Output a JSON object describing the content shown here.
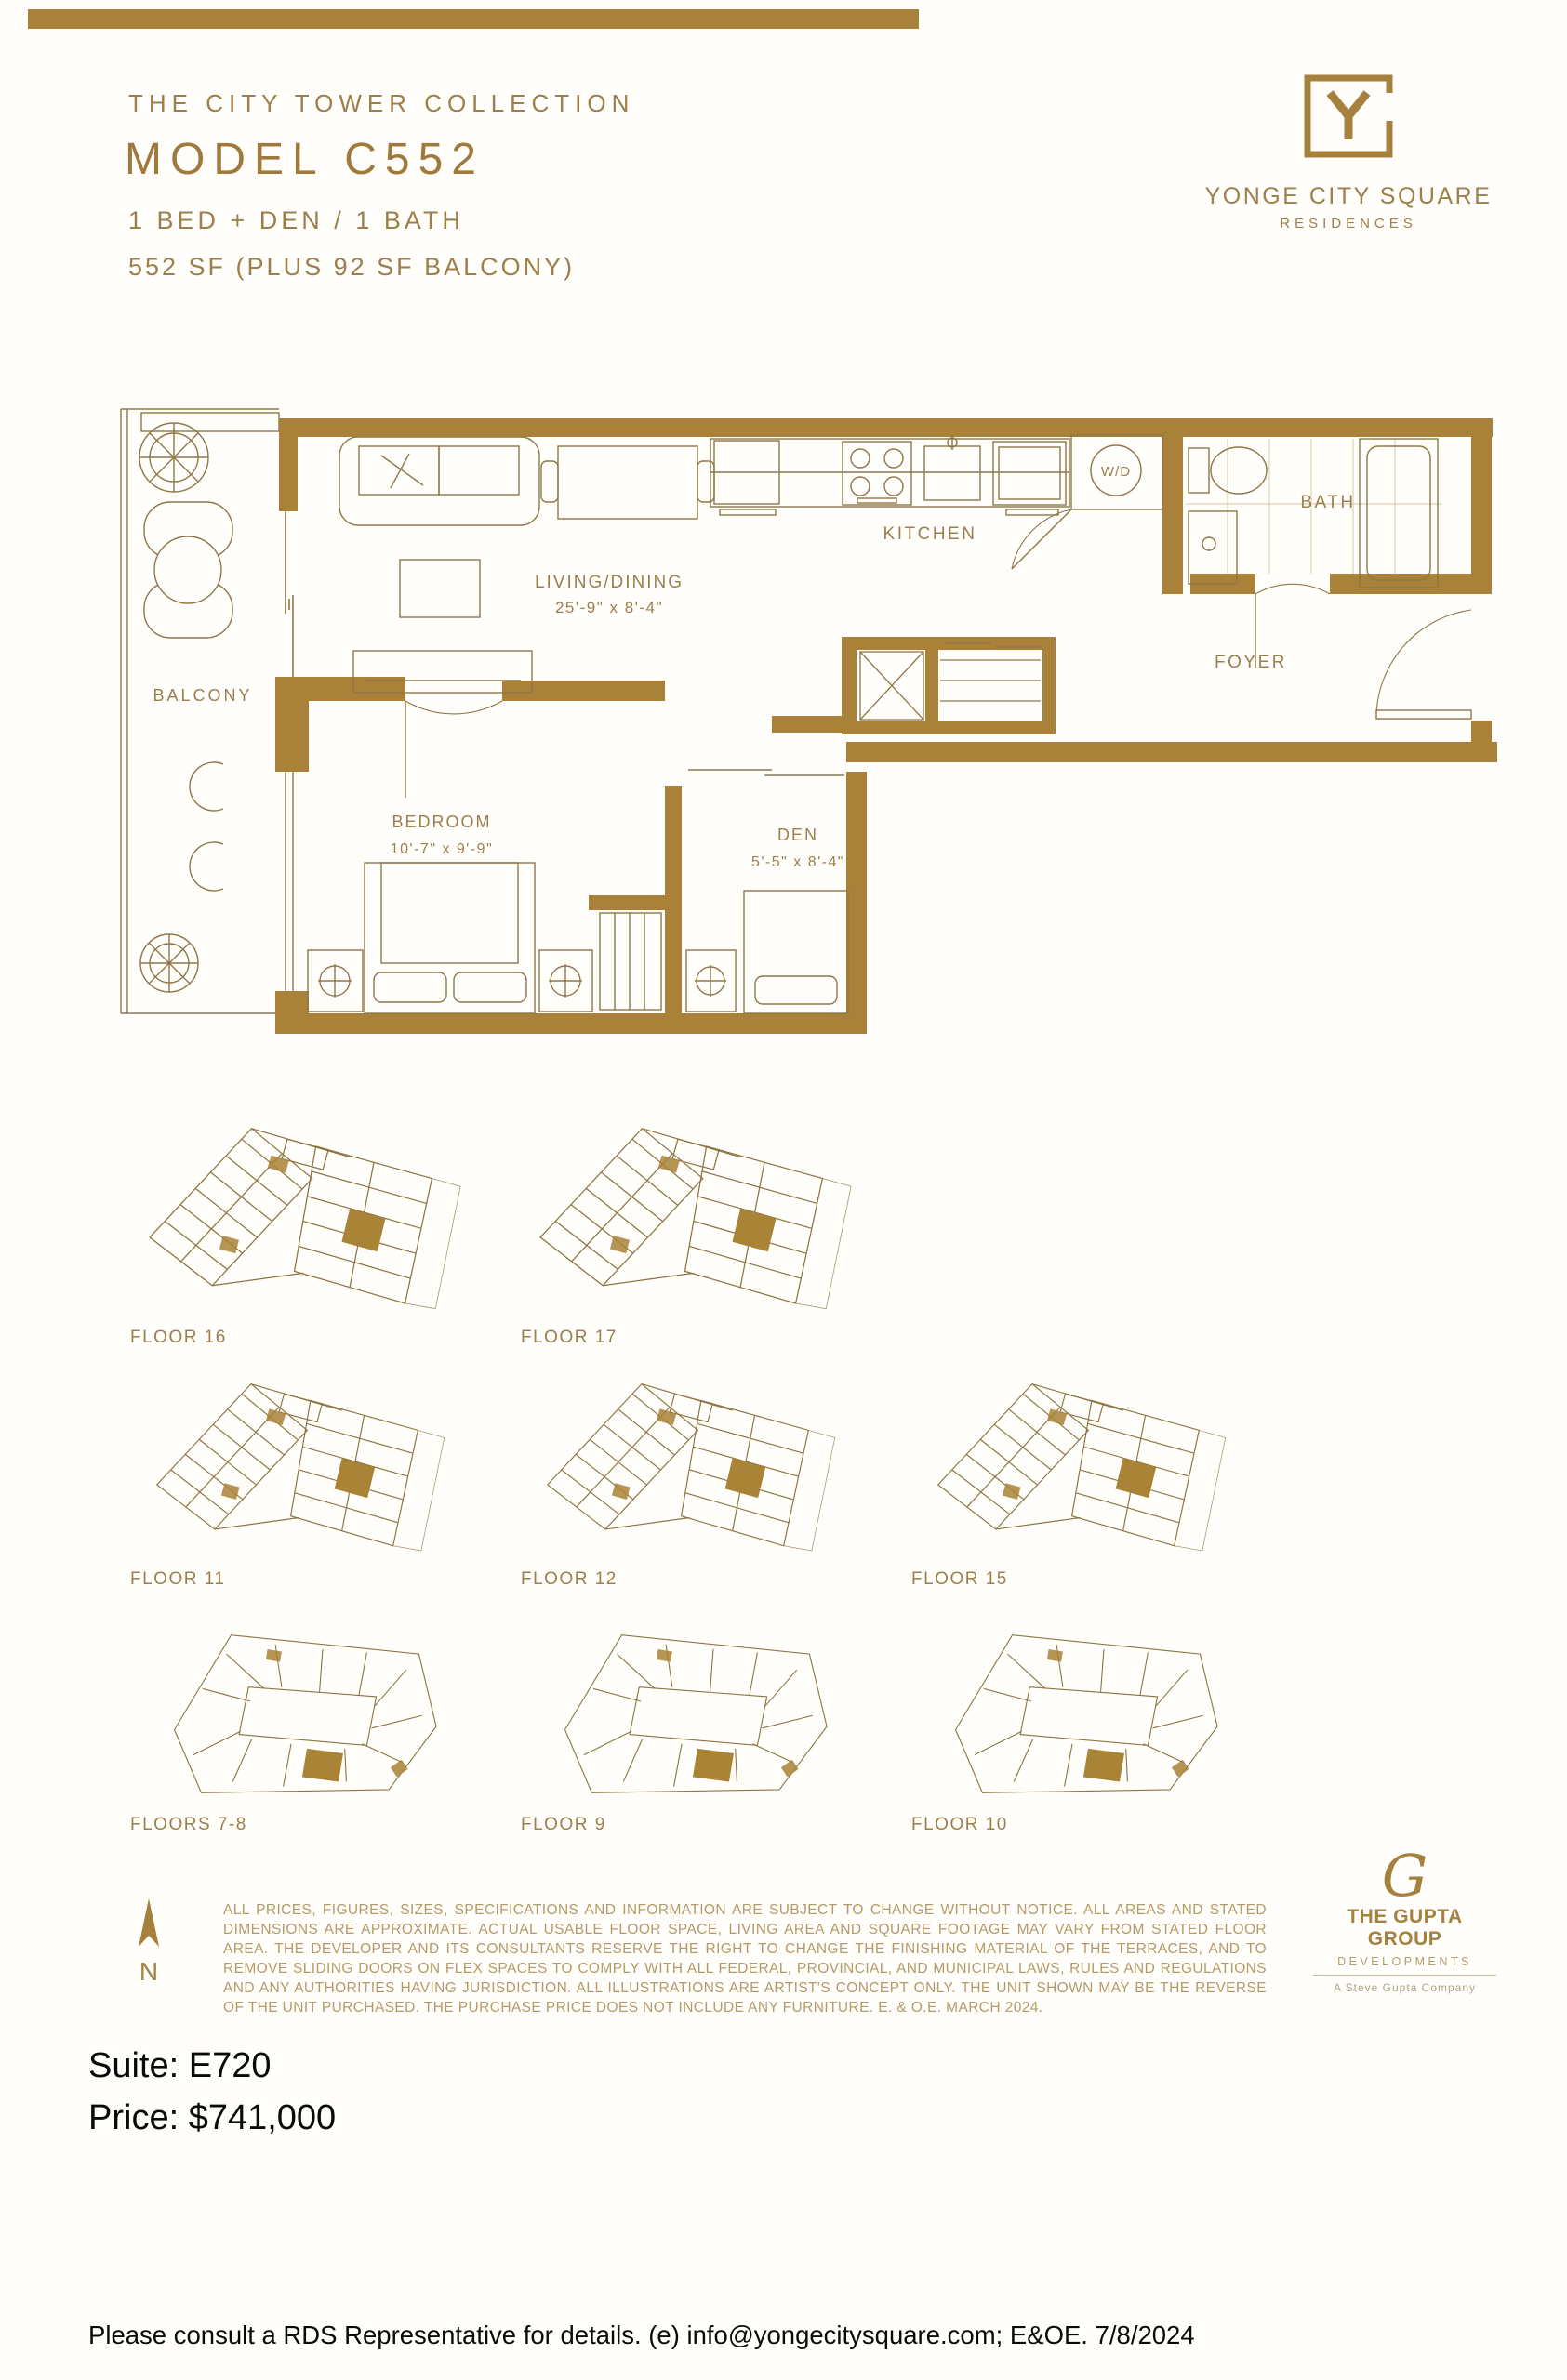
{
  "accent_color": "#a5813d",
  "header": {
    "collection": "THE CITY TOWER COLLECTION",
    "model": "MODEL C552",
    "config": "1 BED + DEN / 1 BATH",
    "area": "552 SF (PLUS 92 SF BALCONY)"
  },
  "brand": {
    "monogram": "Y",
    "name": "YONGE CITY SQUARE",
    "sub": "RESIDENCES"
  },
  "floorplan": {
    "balcony": "BALCONY",
    "living": {
      "name": "LIVING/DINING",
      "dims": "25'-9\" x 8'-4\""
    },
    "kitchen": "KITCHEN",
    "laundry": "W/D",
    "bath": "BATH",
    "foyer": "FOYER",
    "bedroom": {
      "name": "BEDROOM",
      "dims": "10'-7\" x 9'-9\""
    },
    "den": {
      "name": "DEN",
      "dims": "5'-5\" x 8'-4\""
    }
  },
  "keyplates": [
    {
      "label": "FLOOR 16"
    },
    {
      "label": "FLOOR 17"
    },
    {
      "label": "FLOOR 11"
    },
    {
      "label": "FLOOR 12"
    },
    {
      "label": "FLOOR 15"
    },
    {
      "label": "FLOORS 7-8"
    },
    {
      "label": "FLOOR 9"
    },
    {
      "label": "FLOOR 10"
    }
  ],
  "compass": {
    "label": "N"
  },
  "disclaimer": {
    "text": "ALL PRICES, FIGURES, SIZES, SPECIFICATIONS AND INFORMATION ARE SUBJECT TO CHANGE WITHOUT NOTICE. ALL AREAS AND STATED DIMENSIONS ARE APPROXIMATE. ACTUAL USABLE FLOOR SPACE, LIVING AREA AND SQUARE FOOTAGE MAY VARY FROM STATED FLOOR AREA. THE DEVELOPER AND ITS CONSULTANTS RESERVE THE RIGHT TO CHANGE THE FINISHING MATERIAL OF THE TERRACES, AND TO REMOVE SLIDING DOORS ON FLEX SPACES TO COMPLY WITH ALL FEDERAL, PROVINCIAL, AND MUNICIPAL LAWS, RULES AND REGULATIONS AND ANY AUTHORITIES HAVING JURISDICTION. ALL ILLUSTRATIONS ARE ARTIST'S CONCEPT ONLY. THE UNIT SHOWN MAY BE THE REVERSE OF THE UNIT PURCHASED. THE PURCHASE PRICE DOES NOT INCLUDE ANY FURNITURE. E. & O.E. MARCH 2024."
  },
  "developer": {
    "monogram": "G",
    "name": "THE GUPTA GROUP",
    "division": "DEVELOPMENTS",
    "tagline": "A Steve Gupta Company"
  },
  "listing": {
    "suite_line": "Suite: E720",
    "price_line": "Price: $741,000"
  },
  "footer": {
    "text": "Please consult a RDS Representative for details. (e) info@yongecitysquare.com; E&OE. 7/8/2024"
  }
}
